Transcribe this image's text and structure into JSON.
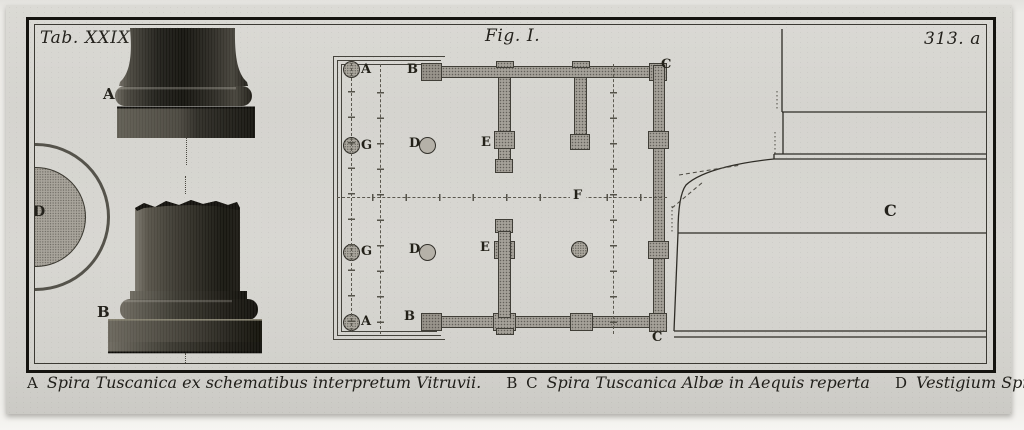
{
  "plate": {
    "tab_label": "Tab. XXIX.",
    "figure_label": "Fig. I.",
    "page_number": "313. a"
  },
  "figures": {
    "base_a": "A",
    "base_b": "B",
    "fragment_d": "D",
    "profile_c": "C"
  },
  "plan": {
    "labels": {
      "a_top": "A",
      "b_top": "B",
      "c_top": "C",
      "g_top": "G",
      "d_top": "D",
      "e_top": "E",
      "f": "F",
      "g_bottom": "G",
      "d_bottom": "D",
      "e_bottom": "E",
      "a_bottom": "A",
      "b_bottom": "B",
      "c_bottom": "C"
    }
  },
  "caption": {
    "entries": [
      {
        "key": "A",
        "text": "Spira Tuscanica ex schematibus interpretum Vitruvii."
      },
      {
        "key": "B C",
        "text": "Spira Tuscanica Albæ in Aequis reperta"
      },
      {
        "key": "D",
        "text": "Vestigium Spiræ Albanæ."
      }
    ]
  },
  "colors": {
    "paper": "#efeeea",
    "plate": "#d6d5d0",
    "ink": "#1e1d19",
    "wall_fill": "#a5a199"
  }
}
